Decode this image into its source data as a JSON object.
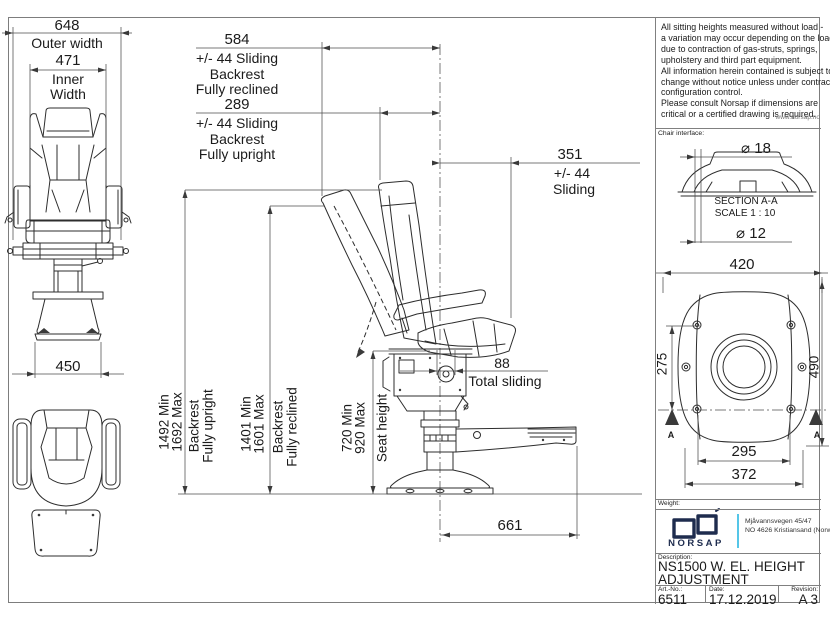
{
  "colors": {
    "accent": "#55c6e8",
    "navy": "#1e2c4e",
    "line": "#2d2d2d"
  },
  "notes": {
    "lines": [
      "All sitting heights measured without load -",
      "a variation may occur depending on the load",
      "due to contraction of gas-struts, springs,",
      "upholstery and third part equipment.",
      "All information herein contained is subject to",
      "change without notice unless under contractual",
      "configuration control.",
      "Please consult Norsap if dimensions are",
      "critical or a certified drawing is required."
    ],
    "website": "www.norsap.no"
  },
  "front_view": {
    "outer": {
      "value": "648",
      "label": "Outer width"
    },
    "inner": {
      "value": "471",
      "label1": "Inner",
      "label2": "Width"
    },
    "base": {
      "value": "450"
    }
  },
  "side_view": {
    "slide_reclined": {
      "value": "584",
      "l1": "+/- 44 Sliding",
      "l2": "Backrest",
      "l3": "Fully reclined"
    },
    "slide_upright": {
      "value": "289",
      "l1": "+/- 44 Sliding",
      "l2": "Backrest",
      "l3": "Fully upright"
    },
    "slide_side": {
      "value": "351",
      "l1": "+/- 44",
      "l2": "Sliding"
    },
    "seat_slide": {
      "value": "88",
      "label": "Total sliding"
    },
    "height_upright": {
      "v1": "1492 Min",
      "v2": "1692 Max",
      "l1": "Backrest",
      "l2": "Fully upright"
    },
    "height_reclined": {
      "v1": "1401 Min",
      "v2": "1601 Max",
      "l1": "Backrest",
      "l2": "Fully reclined"
    },
    "seat_height": {
      "v1": "720 Min",
      "v2": "920 Max",
      "l1": "Seat height"
    },
    "depth": {
      "value": "661"
    }
  },
  "section_view": {
    "interface_label": "Chair interface:",
    "dia_top": "⌀ 18",
    "title": "SECTION A-A",
    "scale": "SCALE 1 : 10",
    "dia_bottom": "⌀ 12"
  },
  "base_view": {
    "width": "420",
    "left_height": "275",
    "right_height": "490",
    "bolt_span": "295",
    "outer_span": "372",
    "marker_left": "A",
    "marker_right": "A"
  },
  "title_block": {
    "weight_label": "Weight:",
    "brand": "NORSAP",
    "address1": "Mjåvannsvegen 45/47",
    "address2": "NO 4626  Kristiansand (Norway)",
    "description_label": "Description:",
    "description1": "NS1500 W. EL. HEIGHT",
    "description2": "ADJUSTMENT",
    "art_label": "Art.-No.:",
    "art_no": "6511",
    "date_label": "Date:",
    "date": "17.12.2019",
    "rev_label": "Revision:",
    "revision": "A 3"
  }
}
